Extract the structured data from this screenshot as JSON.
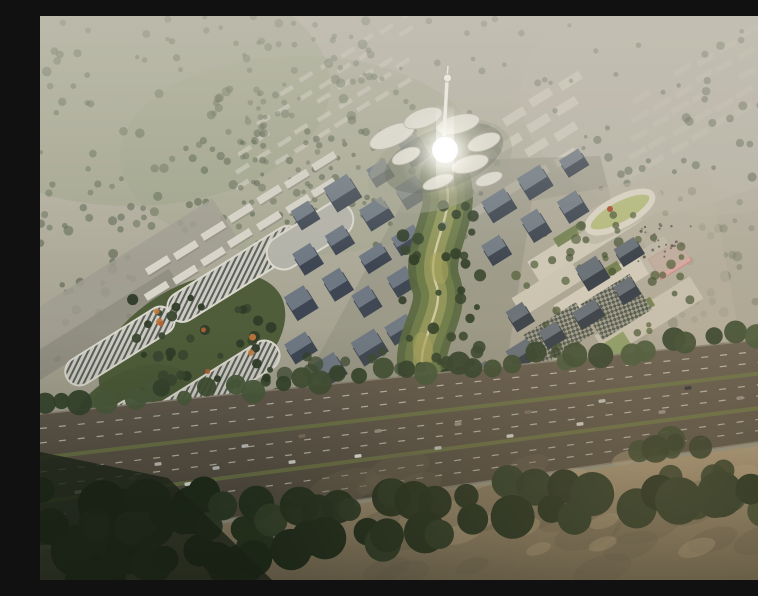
{
  "meta": {
    "title": "Aerial rendering of a master-planned tech campus with central park spine, office tower grids, serpentine green-roof buildings and a highway in the foreground"
  },
  "palette": {
    "haze_top": "#bdbaad",
    "haze_mid": "#b1ae9e",
    "haze_low": "#a4a190",
    "haze_base": "#989584",
    "field_green": "#9aa284",
    "pale_right": "#beb9ab",
    "slab_white": "#d4d1c5",
    "slab_bright": "#dbd8cd",
    "slab_shadow": "#8f8c80",
    "strip_grey": "#a09d90",
    "strip_dark": "#8f8c80",
    "edge_road": "#a8a499",
    "stripe_bg": "#cdccc2",
    "stripe_fg": "#5c605a",
    "parapet": "#dbd8ce",
    "garden_green": "#4f5d3a",
    "garden_green2": "#4a5837",
    "garden_dark": "#3a4830",
    "accent_autumn": "#b25f35",
    "curve_bldg": "#b4b3aa",
    "plaza_right": "#b3ae9e",
    "campus_pad": "#b9b3a2",
    "cream_slab": "#d0cab9",
    "campus_green_roof": "#6d7c4a",
    "pink_court": "#d9a9a4",
    "pink_court_line": "#c9938e",
    "green_court": "#8fa06a",
    "track_ring": "#dcd6c6",
    "track_infield": "#b6bd7f",
    "track_accent": "#a84b2f",
    "checker_bg": "#9c9e90",
    "checker_fg": "#4f544b",
    "dev_pad": "#8b8c7d",
    "park_outer": "#57673f",
    "park_mid": "#6d7c4a",
    "park_inner": "#93985c",
    "park_path": "#d6cfa6",
    "park_glow": "#a8a35c",
    "pond": "#7b8a8a",
    "petal": "#dcd9cf",
    "petal_edge": "#b9b6aa",
    "petal_pad": "#a7a896",
    "petal_shadow": "#6b6f62",
    "spire": "#e9e7de",
    "road_edge": "#8a8274",
    "lane_dash": "#d8d4c6",
    "median_green": "#6e7747",
    "sand_shadow": "#6e6352",
    "sand_patch": "#c2ab87",
    "corner_dark": "#1c2418",
    "wash": "#c5c1b5"
  },
  "scene": {
    "tree_scatter": [
      {
        "layer": "g-scatter",
        "box": [
          0,
          0,
          340,
          215
        ],
        "count": 120,
        "r": [
          2,
          5
        ],
        "colors": [
          "#4c5942",
          "#556349"
        ],
        "opacity": 0.5,
        "seed": 1
      },
      {
        "layer": "g-scatter",
        "box": [
          200,
          0,
          560,
          150
        ],
        "count": 60,
        "r": [
          1.8,
          3.6
        ],
        "colors": [
          "#505e46"
        ],
        "opacity": 0.45,
        "seed": 2
      },
      {
        "layer": "g-scatter",
        "box": [
          555,
          15,
          758,
          250
        ],
        "count": 70,
        "r": [
          2.2,
          4.6
        ],
        "colors": [
          "#4d5a44"
        ],
        "opacity": 0.5,
        "seed": 3
      },
      {
        "layer": "g-scatter",
        "box": [
          0,
          190,
          95,
          345
        ],
        "count": 30,
        "r": [
          2.5,
          5
        ],
        "colors": [
          "#46533d"
        ],
        "opacity": 0.5,
        "seed": 4
      },
      {
        "layer": "g-scatter",
        "box": [
          140,
          115,
          445,
          235
        ],
        "count": 80,
        "r": [
          2,
          4.2
        ],
        "colors": [
          "#44523a"
        ],
        "opacity": 0.55,
        "seed": 5
      },
      {
        "layer": "g-scatter",
        "box": [
          630,
          240,
          758,
          395
        ],
        "count": 45,
        "r": [
          3,
          6
        ],
        "colors": [
          "#4b5941"
        ],
        "opacity": 0.55,
        "seed": 6
      },
      {
        "layer": "g-serp-trees",
        "box": [
          88,
          282,
          235,
          382
        ],
        "count": 42,
        "r": [
          3,
          6
        ],
        "colors": [
          "#3a4830",
          "#2f3c28"
        ],
        "opacity": 0.95,
        "seed": 64
      },
      {
        "layer": "g-serp-trees",
        "box": [
          100,
          295,
          215,
          365
        ],
        "count": 7,
        "r": [
          2.5,
          4
        ],
        "colors": [
          "#b25f35",
          "#c27a3a"
        ],
        "opacity": 0.9,
        "seed": 66
      },
      {
        "layer": "g-campus-trees",
        "box": [
          475,
          195,
          655,
          335
        ],
        "count": 48,
        "r": [
          2.5,
          5
        ],
        "colors": [
          "#42502f",
          "#4d5c38"
        ],
        "opacity": 0.7,
        "seed": 65
      },
      {
        "layer": "g-campus-trees",
        "box": [
          598,
          208,
          652,
          248
        ],
        "count": 26,
        "r": [
          0.8,
          1.6
        ],
        "colors": [
          "#6b675c",
          "#55514a"
        ],
        "opacity": 0.9,
        "seed": 77
      },
      {
        "layer": "g-park-trees",
        "box": [
          362,
          185,
          442,
          430
        ],
        "count": 55,
        "r": [
          3,
          6.5
        ],
        "colors": [
          "#35452c",
          "#2e3c26"
        ],
        "opacity": 0.9,
        "seed": 61
      },
      {
        "layer": "g-late-trees",
        "box": [
          235,
          335,
          640,
          425
        ],
        "count": 45,
        "r": [
          4,
          8
        ],
        "colors": [
          "#3c4a31",
          "#32402a"
        ],
        "opacity": 0.75,
        "seed": 63
      },
      {
        "layer": "g-sand-mottle",
        "box": [
          300,
          450,
          758,
          560
        ],
        "count": 26,
        "r": [
          8,
          20
        ],
        "colors": [
          "#6e6352"
        ],
        "opacity": 0.38,
        "blob": true,
        "seed": 81
      },
      {
        "layer": "g-sand-mottle",
        "box": [
          340,
          440,
          758,
          550
        ],
        "count": 12,
        "r": [
          6,
          14
        ],
        "colors": [
          "#c2ab87"
        ],
        "opacity": 0.45,
        "blob": true,
        "seed": 82
      },
      {
        "layer": "g-fg-trees",
        "box": [
          0,
          460,
          250,
          564
        ],
        "count": 20,
        "r": [
          12,
          26
        ],
        "colors": [
          "#1f2b1a",
          "#27351f"
        ],
        "opacity": 1,
        "seed": 74
      },
      {
        "layer": "g-fg-trees",
        "box": [
          590,
          420,
          758,
          530
        ],
        "count": 14,
        "r": [
          8,
          16
        ],
        "colors": [
          "#39472e",
          "#2f3c26"
        ],
        "opacity": 0.9,
        "seed": 75
      }
    ],
    "tree_lines": [
      {
        "layer": "g-treeline",
        "from": [
          0,
          392
        ],
        "to": [
          758,
          315
        ],
        "count": 36,
        "r": [
          7,
          13
        ],
        "spread": 10,
        "colors": [
          "#3f4e33",
          "#4a5a3b",
          "#35432c"
        ],
        "opacity": 0.95,
        "seed": 71
      },
      {
        "layer": "g-fg-trees",
        "from": [
          0,
          516
        ],
        "to": [
          520,
          468
        ],
        "count": 24,
        "r": [
          11,
          20
        ],
        "spread": 14,
        "colors": [
          "#2c3a25",
          "#33412a",
          "#24311e"
        ],
        "opacity": 0.97,
        "seed": 72
      },
      {
        "layer": "g-fg-trees",
        "from": [
          40,
          560
        ],
        "to": [
          758,
          462
        ],
        "count": 30,
        "r": [
          13,
          24
        ],
        "colors": [
          "#22301d",
          "#2c3a25",
          "#1f2b1a"
        ],
        "spread": 16,
        "opacity": 1,
        "seed": 73
      }
    ],
    "slab_fields": [
      {
        "layer": "g-slabs",
        "origin": [
          205,
          100
        ],
        "angle": -32,
        "cols": 9,
        "du": 24,
        "rows": 5,
        "dv": 17,
        "w": 15,
        "h": 4.5,
        "color": "#d4d1c5",
        "opacity": 0.65,
        "seed": 7,
        "jitter": 2,
        "skip": 0.15
      },
      {
        "layer": "g-slabs",
        "origin": [
          600,
          80
        ],
        "angle": -30,
        "cols": 6,
        "du": 25,
        "rows": 5,
        "dv": 19,
        "w": 19,
        "h": 6,
        "color": "#c8c3b4",
        "opacity": 0.5,
        "seed": 31,
        "jitter": 2,
        "skip": 0.1
      },
      {
        "layer": "g-slabs",
        "origin": [
          445,
          118
        ],
        "angle": -32,
        "cols": 4,
        "du": 33,
        "rows": 4,
        "dv": 25,
        "w": 24,
        "h": 9,
        "color": "#d6d2c4",
        "opacity": 0.8,
        "seed": 41,
        "jitter": 2,
        "skip": 0.1
      },
      {
        "layer": "g-resid",
        "origin": [
          118,
          250
        ],
        "angle": -32,
        "cols": 7,
        "du": 33,
        "rows": 3,
        "dv": 25,
        "w": 26,
        "h": 7.5,
        "color": "#dbd8cd",
        "opacity": 0.95,
        "seed": 21,
        "jitter": 2,
        "skip": 0.08,
        "shadow": true
      }
    ],
    "tower_grids": [
      {
        "origin": [
          268,
          200
        ],
        "angle": -32,
        "cols": 4,
        "du": 41,
        "rows": 5,
        "dv": 44,
        "w": 25,
        "h": 17,
        "roof": "#6e7883",
        "body": "#3d4652",
        "seed": 51,
        "jitter": 3,
        "skip": 0.07
      },
      {
        "origin": [
          462,
          190
        ],
        "angle": -32,
        "cols": 3,
        "du": 42,
        "rows": 2,
        "dv": 44,
        "w": 25,
        "h": 17,
        "roof": "#707a85",
        "body": "#3a434f",
        "seed": 52,
        "jitter": 3,
        "skip": 0.05
      },
      {
        "origin": [
          448,
          320
        ],
        "angle": -32,
        "cols": 5,
        "du": 41,
        "rows": 2,
        "dv": 42,
        "w": 24,
        "h": 16,
        "roof": "#667079",
        "body": "#353e49",
        "seed": 53,
        "jitter": 3,
        "skip": 0.08
      }
    ],
    "cars": {
      "size": [
        7,
        3.4
      ],
      "angle": -6,
      "colors": [
        "#e9e9e7",
        "#d8d7d1",
        "#2f333a",
        "#9a938a",
        "#c3c3be",
        "#7d6f5f"
      ],
      "pos": [
        [
          38,
          476
        ],
        [
          92,
          462
        ],
        [
          148,
          468
        ],
        [
          118,
          448
        ],
        [
          176,
          452
        ],
        [
          205,
          430
        ],
        [
          252,
          446
        ],
        [
          262,
          420
        ],
        [
          318,
          440
        ],
        [
          338,
          415
        ],
        [
          398,
          432
        ],
        [
          418,
          408
        ],
        [
          470,
          420
        ],
        [
          488,
          396
        ],
        [
          540,
          408
        ],
        [
          562,
          385
        ],
        [
          622,
          396
        ],
        [
          648,
          372
        ],
        [
          700,
          382
        ],
        [
          86,
          500
        ],
        [
          160,
          498
        ]
      ]
    }
  }
}
